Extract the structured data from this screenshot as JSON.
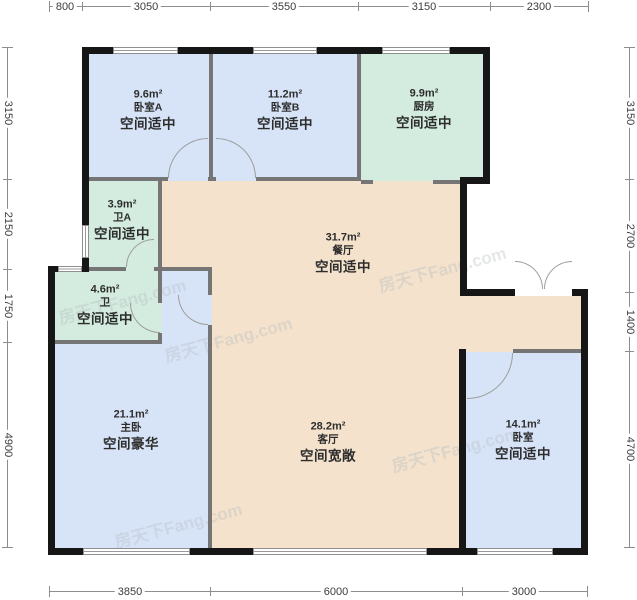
{
  "watermark": "房天下Fang.com",
  "colors": {
    "bedroom": "#d7e4f8",
    "service": "#d3ecdf",
    "living": "#f4e2cc",
    "wall": "#161616"
  },
  "dimensions": {
    "top": [
      "800",
      "3050",
      "3550",
      "3150",
      "2300"
    ],
    "bottom": [
      "3850",
      "6000",
      "3000"
    ],
    "left": [
      "3150",
      "2150",
      "1750",
      "4900"
    ],
    "right": [
      "3150",
      "2700",
      "1400",
      "4700"
    ]
  },
  "rooms": [
    {
      "area": "9.6m²",
      "name": "卧室A",
      "desc": "空间适中"
    },
    {
      "area": "11.2m²",
      "name": "卧室B",
      "desc": "空间适中"
    },
    {
      "area": "9.9m²",
      "name": "厨房",
      "desc": "空间适中"
    },
    {
      "area": "3.9m²",
      "name": "卫A",
      "desc": "空间适中"
    },
    {
      "area": "4.6m²",
      "name": "卫",
      "desc": "空间适中"
    },
    {
      "area": "31.7m²",
      "name": "餐厅",
      "desc": "空间适中"
    },
    {
      "area": "21.1m²",
      "name": "主卧",
      "desc": "空间豪华"
    },
    {
      "area": "28.2m²",
      "name": "客厅",
      "desc": "空间宽敞"
    },
    {
      "area": "14.1m²",
      "name": "卧室",
      "desc": "空间适中"
    }
  ]
}
